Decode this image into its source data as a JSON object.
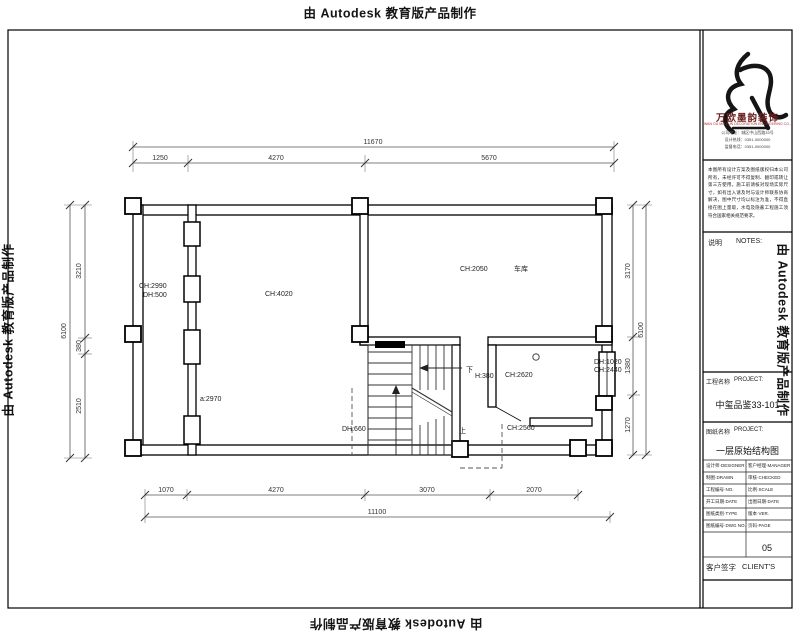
{
  "watermark": {
    "text": "由 Autodesk 教育版产品制作"
  },
  "plan": {
    "labels": {
      "room_left_ch": "CH:2990",
      "room_left_dh": "DH:500",
      "room_main_ch": "CH:4020",
      "garage_ch": "CH:2050",
      "garage_name": "车库",
      "stair_down": "下",
      "stair_up": "上",
      "stair_dh": "DH:660",
      "stair_a": "a:2970",
      "room_small_h": "H:380",
      "room_small_ch": "CH:2620",
      "window_dh": "DH:1020",
      "window_ch": "CH:2440",
      "area_ch": "CH:2560"
    },
    "dims": {
      "top_total": "11670",
      "top": [
        "1250",
        "4270",
        "5670"
      ],
      "bottom": [
        "1070",
        "4270",
        "3070",
        "2070"
      ],
      "bottom_total": "11100",
      "left": [
        "3210",
        "380",
        "2510"
      ],
      "left_total": "6100",
      "right": [
        "3170",
        "1380",
        "1270"
      ],
      "right_total": "6100"
    }
  },
  "titleblock": {
    "brand_name": "万欧墨韵装饰",
    "brand_sub": "WAN OU MO YUN DECORATION ENGINEERING CO.,LTD",
    "address_lines": [
      "公司地址：城区中山西路33号",
      "设计热线：0351-0000000",
      "监督电话：0351-0000000"
    ],
    "disclaimer": "本图所有设计方案及图纸版权归本公司所有，未经许可不得复制、翻印或转让第三方使用。施工前请核对现场实际尺寸，如有出入请及时与设计师联系协商解决，图中尺寸均以标注为准，不得直接在图上量取，水电及隐蔽工程施工须符合国家相关规范要求。",
    "notes_cn": "说明",
    "notes_en": "NOTES:",
    "project_label_cn": "工程名称",
    "project_label_en": "PROJECT:",
    "project_value": "中玺品鉴33-101",
    "drawing_label_cn": "图纸名称",
    "drawing_label_en": "PROJECT:",
    "drawing_value": "一层原始结构图",
    "table_rows": [
      {
        "l": "设计师·DESIGNER",
        "r": "客户经理·MANAGER"
      },
      {
        "l": "制图·DRAWN",
        "r": "审核·CHECKED"
      },
      {
        "l": "工程编号·NO.",
        "r": "比例·SCALE"
      },
      {
        "l": "开工日期·DATE",
        "r": "出图日期·DATE"
      },
      {
        "l": "图纸类别·TYPE",
        "r": "版本·VER."
      },
      {
        "l": "图纸编号·DWG NO.",
        "r": "页码·PAGE"
      }
    ],
    "page_no": "05",
    "client_label_cn": "客户签字",
    "client_label_en": "CLIENT'S"
  }
}
